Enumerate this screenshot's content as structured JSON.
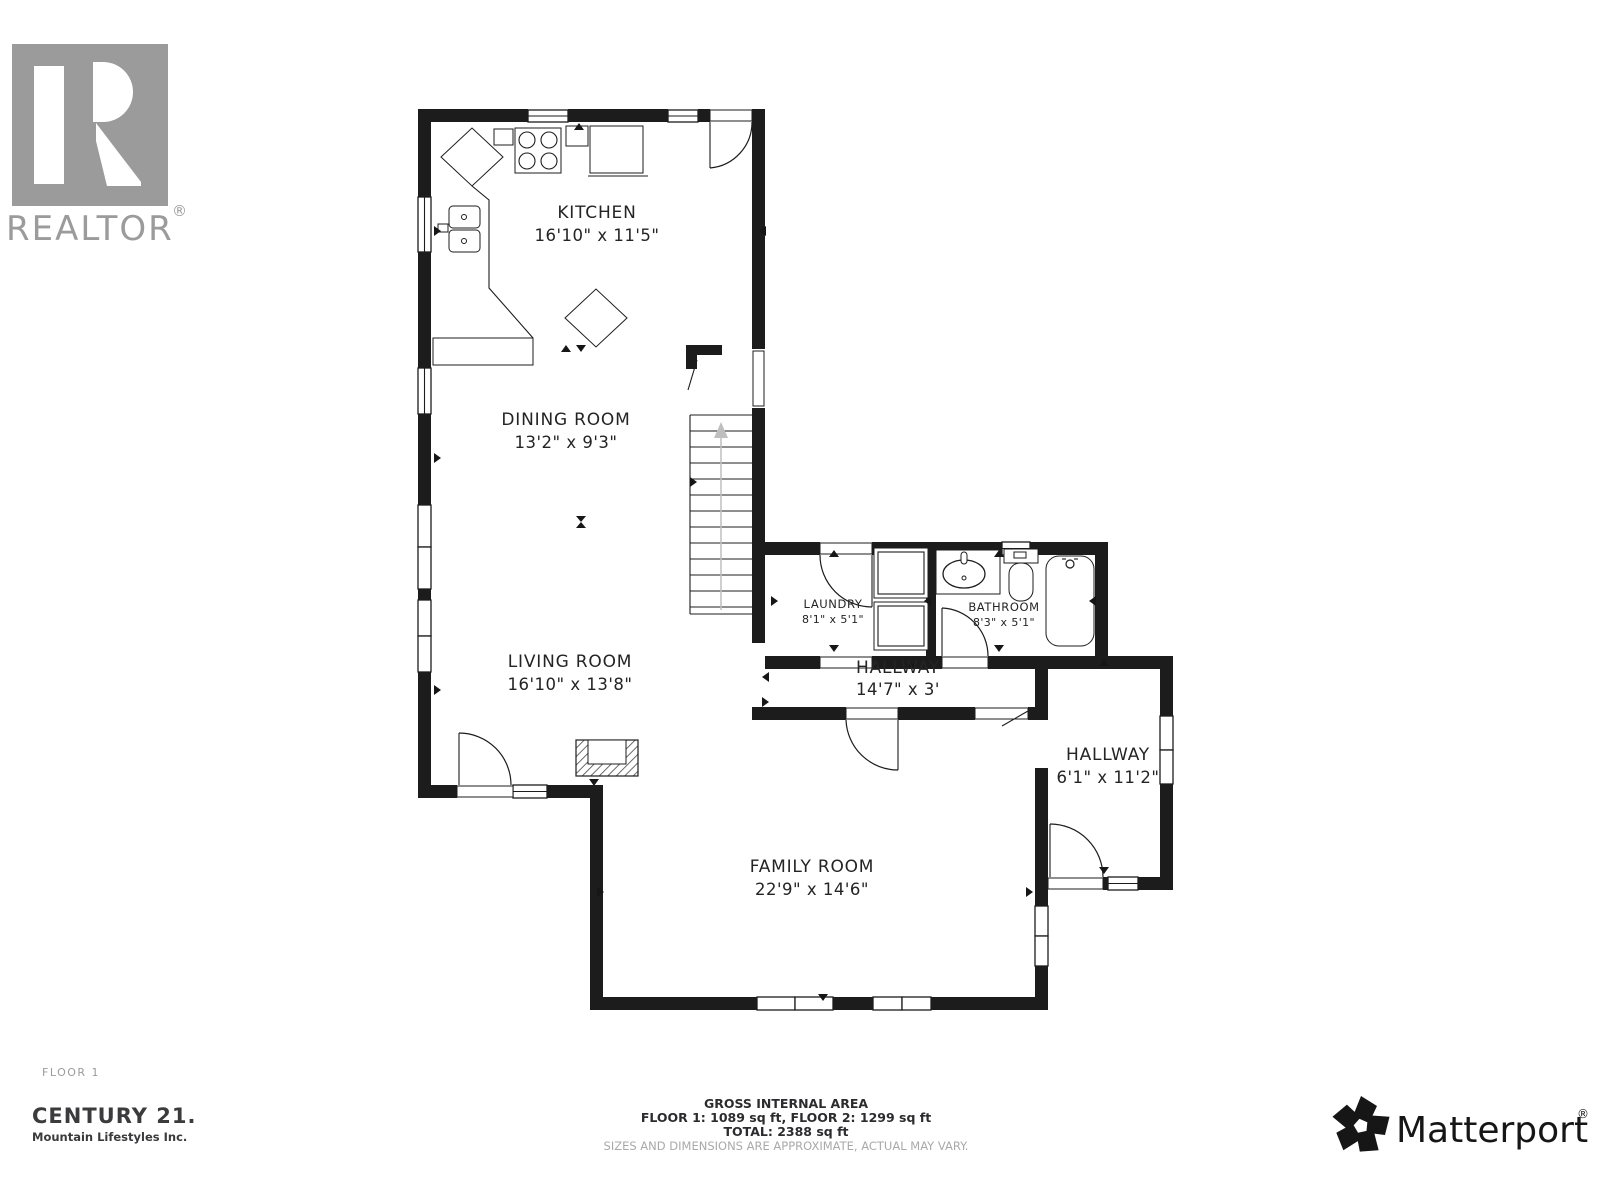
{
  "branding": {
    "realtor": {
      "logo_text": "REALTOR",
      "reg_mark": "®"
    },
    "century21": {
      "name": "CENTURY 21.",
      "subtitle": "Mountain Lifestyles Inc."
    },
    "matterport": {
      "name": "Matterport",
      "reg_mark": "®"
    }
  },
  "floor_label": "FLOOR 1",
  "rooms": [
    {
      "name": "KITCHEN",
      "dims": "16'10\" x 11'5\""
    },
    {
      "name": "DINING ROOM",
      "dims": "13'2\" x 9'3\""
    },
    {
      "name": "LIVING ROOM",
      "dims": "16'10\" x 13'8\""
    },
    {
      "name": "LAUNDRY",
      "dims": "8'1\" x 5'1\""
    },
    {
      "name": "BATHROOM",
      "dims": "8'3\" x 5'1\""
    },
    {
      "name": "HALLWAY",
      "dims": "14'7\" x 3'"
    },
    {
      "name": "HALLWAY",
      "dims": "6'1\" x 11'2\""
    },
    {
      "name": "FAMILY ROOM",
      "dims": "22'9\" x 14'6\""
    }
  ],
  "footer": {
    "area_title": "GROSS INTERNAL AREA",
    "area_floors": "FLOOR 1: 1089 sq ft, FLOOR 2: 1299 sq ft",
    "area_total": "TOTAL: 2388 sq ft",
    "disclaimer": "SIZES AND DIMENSIONS ARE APPROXIMATE, ACTUAL MAY VARY."
  },
  "colors": {
    "wall": "#1c1c1c",
    "logo_gray": "#9b9b9b",
    "text_dark": "#2c2c2e"
  }
}
